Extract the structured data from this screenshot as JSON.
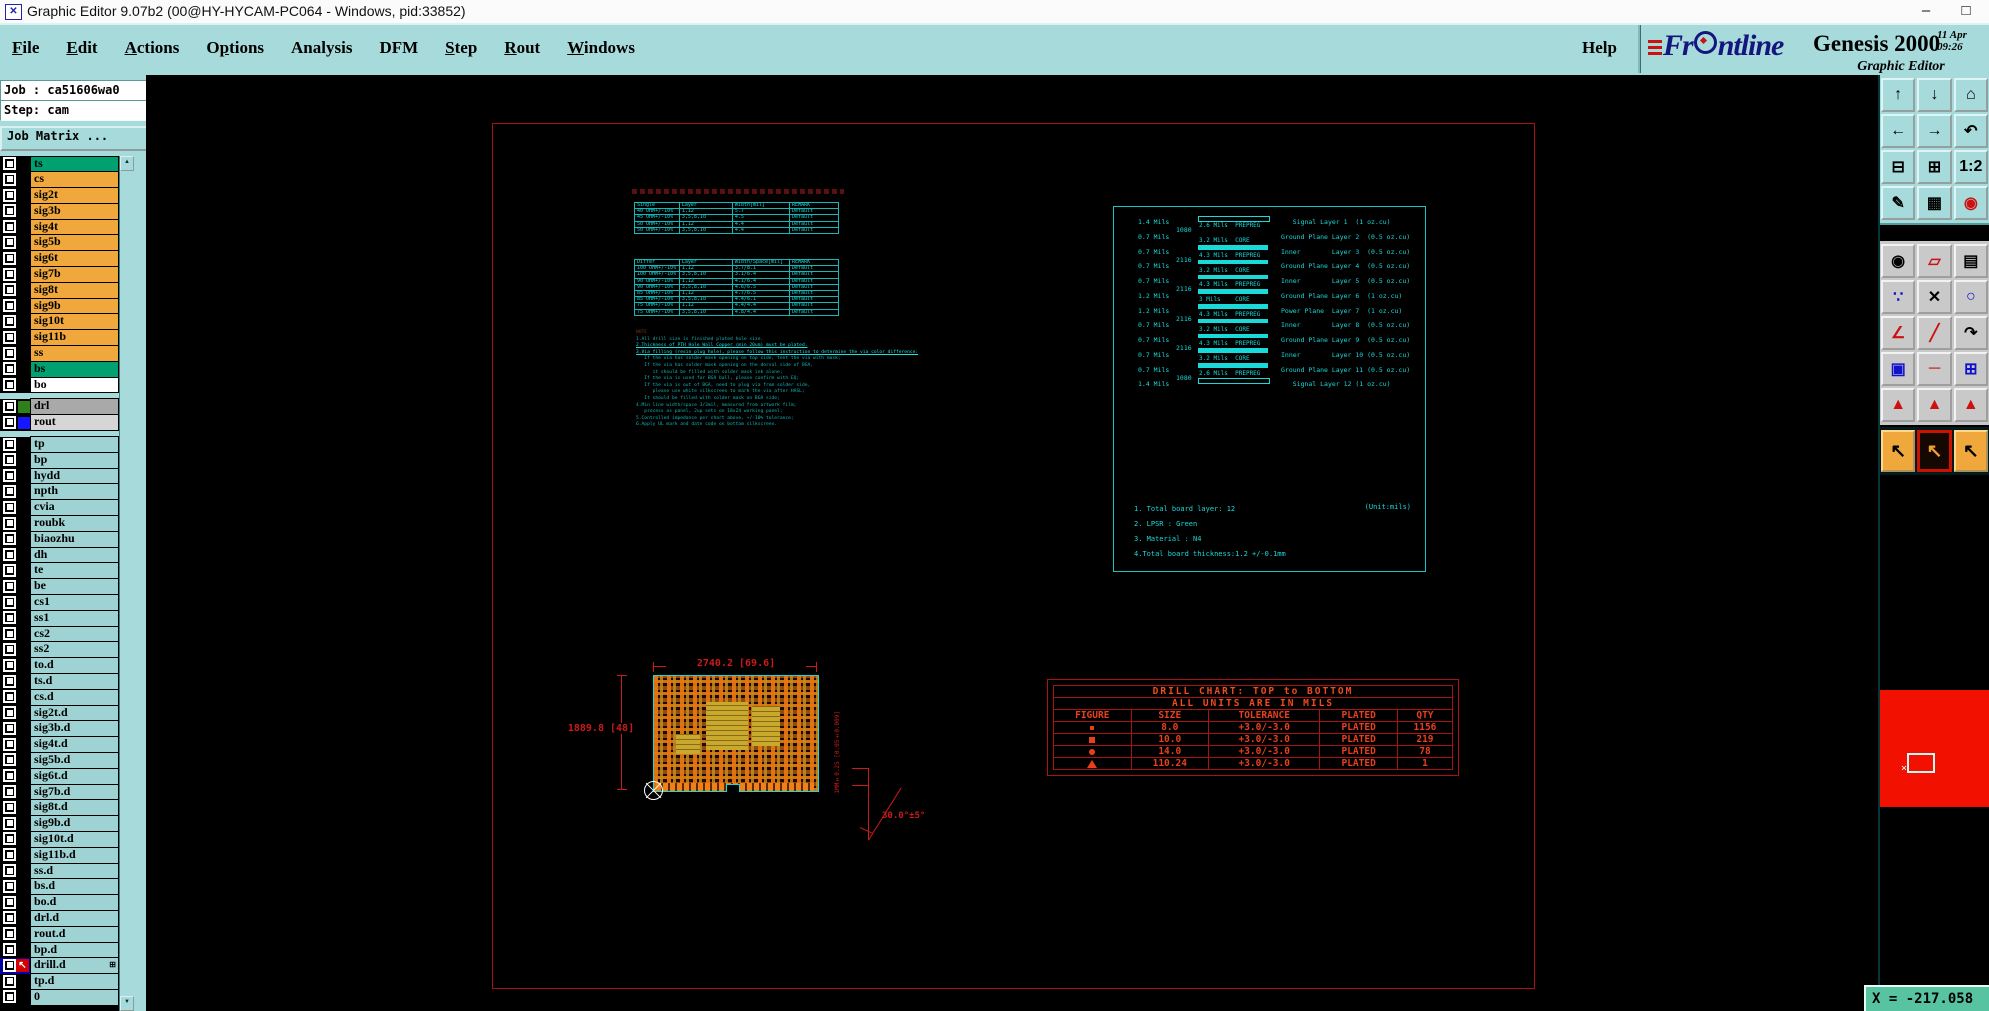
{
  "colors": {
    "teal_panel": "#a7dada",
    "orange_row": "#f0a83c",
    "green_row": "#00a070",
    "cyan_row": "#9fd2d2",
    "draw_cyan": "#1ad9d9",
    "draw_red": "#cc1a1a",
    "chart_red": "#e8401c",
    "overview_red": "#f21000",
    "status_green": "#57c3a0"
  },
  "window": {
    "title": "Graphic Editor 9.07b2 (00@HY-HYCAM-PC064 - Windows, pid:33852)",
    "icon_glyph": "✕",
    "minimize": "–",
    "maximize": "□"
  },
  "menu": {
    "items": [
      {
        "label": "File",
        "u": 0
      },
      {
        "label": "Edit",
        "u": 0
      },
      {
        "label": "Actions",
        "u": 0
      },
      {
        "label": "Options",
        "u": 1
      },
      {
        "label": "Analysis",
        "u": -1
      },
      {
        "label": "DFM",
        "u": -1
      },
      {
        "label": "Step",
        "u": 0
      },
      {
        "label": "Rout",
        "u": 0
      },
      {
        "label": "Windows",
        "u": 0
      }
    ],
    "help_label": "Help"
  },
  "brand": {
    "logo_pre": "Fr",
    "logo_post": "ntline",
    "product": "Genesis 2000",
    "date": "11 Apr",
    "time": "09:26",
    "subtitle": "Graphic Editor"
  },
  "job_panel": {
    "job_label": "Job : ca51606wa0",
    "step_label": "Step: cam",
    "matrix_button": "Job Matrix ...",
    "scroll_up": "▲",
    "scroll_down": "▼"
  },
  "layers": {
    "rows": [
      {
        "name": "ts",
        "style": "selected"
      },
      {
        "name": "cs",
        "style": "orange"
      },
      {
        "name": "sig2t",
        "style": "orange"
      },
      {
        "name": "sig3b",
        "style": "orange"
      },
      {
        "name": "sig4t",
        "style": "orange"
      },
      {
        "name": "sig5b",
        "style": "orange"
      },
      {
        "name": "sig6t",
        "style": "orange"
      },
      {
        "name": "sig7b",
        "style": "orange"
      },
      {
        "name": "sig8t",
        "style": "orange"
      },
      {
        "name": "sig9b",
        "style": "orange"
      },
      {
        "name": "sig10t",
        "style": "orange"
      },
      {
        "name": "sig11b",
        "style": "orange"
      },
      {
        "name": "ss",
        "style": "orange"
      },
      {
        "name": "bs",
        "style": "green"
      },
      {
        "name": "bo",
        "style": "white"
      },
      {
        "sep": true
      },
      {
        "name": "drl",
        "style": "gray",
        "swatch": "#2e8018"
      },
      {
        "name": "rout",
        "style": "silver",
        "swatch": "#1616ff"
      },
      {
        "sep": true
      },
      {
        "name": "tp",
        "style": "cyan"
      },
      {
        "name": "bp",
        "style": "cyan"
      },
      {
        "name": "hydd",
        "style": "cyan"
      },
      {
        "name": "npth",
        "style": "cyan"
      },
      {
        "name": "cvia",
        "style": "cyan"
      },
      {
        "name": "roubk",
        "style": "cyan"
      },
      {
        "name": "biaozhu",
        "style": "cyan"
      },
      {
        "name": "dh",
        "style": "cyan"
      },
      {
        "name": "te",
        "style": "cyan"
      },
      {
        "name": "be",
        "style": "cyan"
      },
      {
        "name": "cs1",
        "style": "cyan"
      },
      {
        "name": "ss1",
        "style": "cyan"
      },
      {
        "name": "cs2",
        "style": "cyan"
      },
      {
        "name": "ss2",
        "style": "cyan"
      },
      {
        "name": "to.d",
        "style": "cyan"
      },
      {
        "name": "ts.d",
        "style": "cyan"
      },
      {
        "name": "cs.d",
        "style": "cyan"
      },
      {
        "name": "sig2t.d",
        "style": "cyan"
      },
      {
        "name": "sig3b.d",
        "style": "cyan"
      },
      {
        "name": "sig4t.d",
        "style": "cyan"
      },
      {
        "name": "sig5b.d",
        "style": "cyan"
      },
      {
        "name": "sig6t.d",
        "style": "cyan"
      },
      {
        "name": "sig7b.d",
        "style": "cyan"
      },
      {
        "name": "sig8t.d",
        "style": "cyan"
      },
      {
        "name": "sig9b.d",
        "style": "cyan"
      },
      {
        "name": "sig10t.d",
        "style": "cyan"
      },
      {
        "name": "sig11b.d",
        "style": "cyan"
      },
      {
        "name": "ss.d",
        "style": "cyan"
      },
      {
        "name": "bs.d",
        "style": "cyan"
      },
      {
        "name": "bo.d",
        "style": "cyan"
      },
      {
        "name": "drl.d",
        "style": "cyan"
      },
      {
        "name": "rout.d",
        "style": "cyan"
      },
      {
        "name": "bp.d",
        "style": "cyan"
      },
      {
        "name": "drill.d",
        "style": "cyan",
        "active": true,
        "expand_glyph": "⊞",
        "arrow_glyph": "↖"
      },
      {
        "name": "tp.d",
        "style": "cyan"
      },
      {
        "name": "0",
        "style": "cyan"
      }
    ]
  },
  "impedance_single": {
    "columns": [
      "Single",
      "Layer",
      "Width[mil]",
      "REMARK"
    ],
    "rows": [
      [
        "40 OHM+/-10%",
        "1,12",
        "5.7",
        "Default"
      ],
      [
        "45 OHM+/-10%",
        "3,5,8,10",
        "4.5",
        "Default"
      ],
      [
        "50 OHM+/-10%",
        "1,12",
        "4.4",
        "Default"
      ],
      [
        "50 OHM+/-10%",
        "3,5,8,10",
        "4.4",
        "Default"
      ]
    ]
  },
  "impedance_differ": {
    "columns": [
      "Differ",
      "Layer",
      "Width/Space[mil]",
      "REMARK"
    ],
    "rows": [
      [
        "100 OHM+/-10%",
        "1,12",
        "3.7/8.1",
        "Default"
      ],
      [
        "100 OHM+/-10%",
        "3,5,8,10",
        "3.1/6.4",
        "Default"
      ],
      [
        "90 OHM+/-10%",
        "1,12",
        "4.1/6.4",
        "Default"
      ],
      [
        "90 OHM+/-10%",
        "3,5,8,10",
        "4.6/6.5",
        "Default"
      ],
      [
        "85 OHM+/-10%",
        "1,12",
        "4.7/6.5",
        "Default"
      ],
      [
        "85 OHM+/-10%",
        "3,5,8,10",
        "4.4/6.1",
        "Default"
      ],
      [
        "75 OHM+/-10%",
        "1,12",
        "4.4/4.4",
        "Default"
      ],
      [
        "75 OHM+/-10%",
        "3,5,8,10",
        "4.8/4.4",
        "Default"
      ]
    ]
  },
  "fab_notes": {
    "lines": [
      {
        "t": "NOTE",
        "c": "dim"
      },
      {
        "t": "1.All drill size is finished plated hole size.",
        "c": ""
      },
      {
        "t": "2.Thickness of PTH Hole Wall Copper (min 20um) must be plated.",
        "c": "hl"
      },
      {
        "t": "3.Via filling (resin plug hole), please follow this instruction to determine the via color difference:",
        "c": "hl"
      },
      {
        "t": "   If the via has solder mask opening on top side, tent the via with mask;",
        "c": ""
      },
      {
        "t": "   If the via has solder mask opening on the dorsal side of BGA,",
        "c": ""
      },
      {
        "t": "      it should be filled with solder mask ink alone;",
        "c": ""
      },
      {
        "t": "   If the via is used for BGA ball, please confirm with EQ;",
        "c": ""
      },
      {
        "t": "   If the via is out of BGA, need to plug via from solder side,",
        "c": ""
      },
      {
        "t": "      please use white silkscreen to mark the via after HASL;",
        "c": ""
      },
      {
        "t": "   It should be filled with solder mask on BGA side;",
        "c": ""
      },
      {
        "t": "4.Min line width/space 3/3mil, measured from artwork film;",
        "c": ""
      },
      {
        "t": "   process as panel, 2up sets on 18x24 working panel;",
        "c": ""
      },
      {
        "t": "5.Controlled impedance per chart above, +/-10% tolerance;",
        "c": ""
      },
      {
        "t": "6.Apply UL mark and date code on bottom silkscreen.",
        "c": ""
      }
    ]
  },
  "stackup": {
    "copper": [
      {
        "th": "1.4 Mils",
        "desc": "   Signal Layer 1  (1 oz.cu)"
      },
      {
        "th": "0.7 Mils",
        "desc": "Ground Plane Layer 2  (0.5 oz.cu)"
      },
      {
        "th": "0.7 Mils",
        "desc": "Inner        Layer 3  (0.5 oz.cu)"
      },
      {
        "th": "0.7 Mils",
        "desc": "Ground Plane Layer 4  (0.5 oz.cu)"
      },
      {
        "th": "0.7 Mils",
        "desc": "Inner        Layer 5  (0.5 oz.cu)"
      },
      {
        "th": "1.2 Mils",
        "desc": "Ground Plane Layer 6  (1 oz.cu)"
      },
      {
        "th": "1.2 Mils",
        "desc": "Power Plane  Layer 7  (1 oz.cu)"
      },
      {
        "th": "0.7 Mils",
        "desc": "Inner        Layer 8  (0.5 oz.cu)"
      },
      {
        "th": "0.7 Mils",
        "desc": "Ground Plane Layer 9  (0.5 oz.cu)"
      },
      {
        "th": "0.7 Mils",
        "desc": "Inner        Layer 10 (0.5 oz.cu)"
      },
      {
        "th": "0.7 Mils",
        "desc": "Ground Plane Layer 11 (0.5 oz.cu)"
      },
      {
        "th": "1.4 Mils",
        "desc": "   Signal Layer 12 (1 oz.cu)"
      }
    ],
    "dielectrics": [
      {
        "code": "1080",
        "label": "2.6 Mils  PREPREG",
        "type": "outline"
      },
      {
        "code": "",
        "label": "3.2 Mils  CORE",
        "type": "solid"
      },
      {
        "code": "2116",
        "label": "4.3 Mils  PREPREG",
        "type": "solid"
      },
      {
        "code": "",
        "label": "3.2 Mils  CORE",
        "type": "solid"
      },
      {
        "code": "2116",
        "label": "4.3 Mils  PREPREG",
        "type": "solid"
      },
      {
        "code": "",
        "label": "3 Mils    CORE",
        "type": "solid"
      },
      {
        "code": "2116",
        "label": "4.3 Mils  PREPREG",
        "type": "solid"
      },
      {
        "code": "",
        "label": "3.2 Mils  CORE",
        "type": "solid"
      },
      {
        "code": "2116",
        "label": "4.3 Mils  PREPREG",
        "type": "solid"
      },
      {
        "code": "",
        "label": "3.2 Mils  CORE",
        "type": "solid"
      },
      {
        "code": "1080",
        "label": "2.6 Mils  PREPREG",
        "type": "outline"
      }
    ],
    "notes": [
      "1. Total board layer: 12",
      "2. LPSR : Green",
      "3. Material : N4",
      "4.Total board thickness:1.2 +/-0.1mm"
    ],
    "unit_note": "(Unit:mils)"
  },
  "board": {
    "dim_width": "2740.2 [69.6]",
    "dim_height": "1889.8 [48]",
    "bevel_dim": "1MM±0.25 [0.05±0.009]",
    "bevel_angle": "30.0°±5°"
  },
  "drill_chart": {
    "title": "DRILL CHART: TOP to BOTTOM",
    "subtitle": "ALL UNITS ARE IN MILS",
    "columns": [
      "FIGURE",
      "SIZE",
      "TOLERANCE",
      "PLATED",
      "QTY"
    ],
    "rows": [
      {
        "figure": "sq-s",
        "size": "8.0",
        "tolerance": "+3.0/-3.0",
        "plated": "PLATED",
        "qty": "1156"
      },
      {
        "figure": "sq-m",
        "size": "10.0",
        "tolerance": "+3.0/-3.0",
        "plated": "PLATED",
        "qty": "219"
      },
      {
        "figure": "dot",
        "size": "14.0",
        "tolerance": "+3.0/-3.0",
        "plated": "PLATED",
        "qty": "78"
      },
      {
        "figure": "tri",
        "size": "110.24",
        "tolerance": "+3.0/-3.0",
        "plated": "PLATED",
        "qty": "1"
      }
    ]
  },
  "toolbar": {
    "teal_buttons": [
      {
        "name": "view-up",
        "glyph": "↑"
      },
      {
        "name": "view-down",
        "glyph": "↓"
      },
      {
        "name": "home-view",
        "glyph": "⌂"
      },
      {
        "name": "view-left",
        "glyph": "←"
      },
      {
        "name": "view-right",
        "glyph": "→"
      },
      {
        "name": "previous-view",
        "glyph": "↶"
      },
      {
        "name": "zoom-out",
        "glyph": "⊟"
      },
      {
        "name": "zoom-in",
        "glyph": "⊞"
      },
      {
        "name": "zoom-ratio",
        "glyph": "1:2"
      },
      {
        "name": "setup",
        "glyph": "✎"
      },
      {
        "name": "grid",
        "glyph": "▦"
      },
      {
        "name": "layer-display",
        "glyph": "◉",
        "tint": "red",
        "active": true
      }
    ],
    "gray_buttons": [
      {
        "name": "select-move",
        "glyph": "◉"
      },
      {
        "name": "transform-shape",
        "glyph": "▱",
        "tint": "red"
      },
      {
        "name": "measure-ruler",
        "glyph": "▤"
      },
      {
        "name": "net-points",
        "glyph": "∵",
        "tint": "blue"
      },
      {
        "name": "delete",
        "glyph": "✕"
      },
      {
        "name": "add-pad",
        "glyph": "○",
        "tint": "blue"
      },
      {
        "name": "angle-measure",
        "glyph": "∠",
        "tint": "red"
      },
      {
        "name": "add-line",
        "glyph": "╱",
        "tint": "red"
      },
      {
        "name": "add-arc",
        "glyph": "↷"
      },
      {
        "name": "copy-shape",
        "glyph": "▣",
        "tint": "blue"
      },
      {
        "name": "highlight-line",
        "glyph": "─",
        "tint": "red"
      },
      {
        "name": "measure-box",
        "glyph": "⊞",
        "tint": "blue"
      },
      {
        "name": "truncate-top",
        "glyph": "▲",
        "tint": "red"
      },
      {
        "name": "move-top",
        "glyph": "▲",
        "tint": "red"
      },
      {
        "name": "align-top",
        "glyph": "▲",
        "tint": "red"
      }
    ],
    "select_buttons": [
      {
        "name": "select-mode-single",
        "glyph": "↖"
      },
      {
        "name": "select-mode-frame",
        "glyph": "↖",
        "active": true
      },
      {
        "name": "select-mode-poly",
        "glyph": "↖"
      }
    ]
  },
  "overview": {
    "marker": "×"
  },
  "status": {
    "coords": "X = -217.058"
  }
}
